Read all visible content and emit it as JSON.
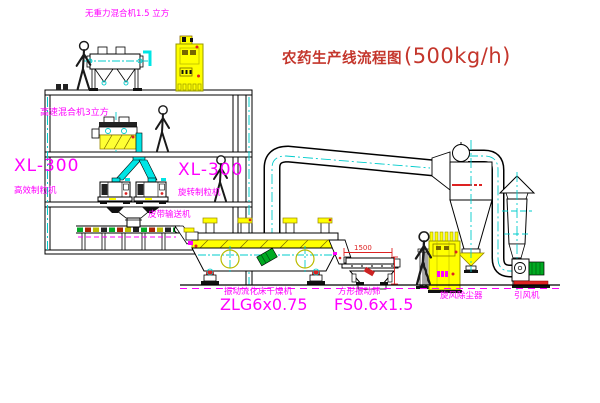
{
  "title": {
    "name": "农药生产线流程图",
    "capacity": "(500kg/h)"
  },
  "labels": {
    "top_mixer": "无重力混合机1.5 立方",
    "high_speed_mixer": "高速混合机3立方",
    "granulator_left_model": "XL-300",
    "granulator_left_name": "高效制粒机",
    "granulator_right_model": "XL-300",
    "granulator_right_name": "旋转制粒机",
    "belt_conveyor": "皮带输送机",
    "dryer_name": "振动流化床干燥机",
    "dryer_model": "ZLG6x0.75",
    "sieve_name": "方形振动筛",
    "sieve_model": "FS0.6x1.5",
    "cyclone": "旋风除尘器",
    "fan": "引风机"
  },
  "dimensions": {
    "sieve_width": "1500"
  },
  "colors": {
    "label_magenta": "#FF00FF",
    "title_red": "#C4362C",
    "line_black": "#000000",
    "centerline_cyan": "#00CCCC",
    "equipment_yellow": "#FFFF00",
    "accent_red": "#DD2222",
    "motor_green": "#00AA22",
    "chute_cyan": "#00E5E5"
  }
}
